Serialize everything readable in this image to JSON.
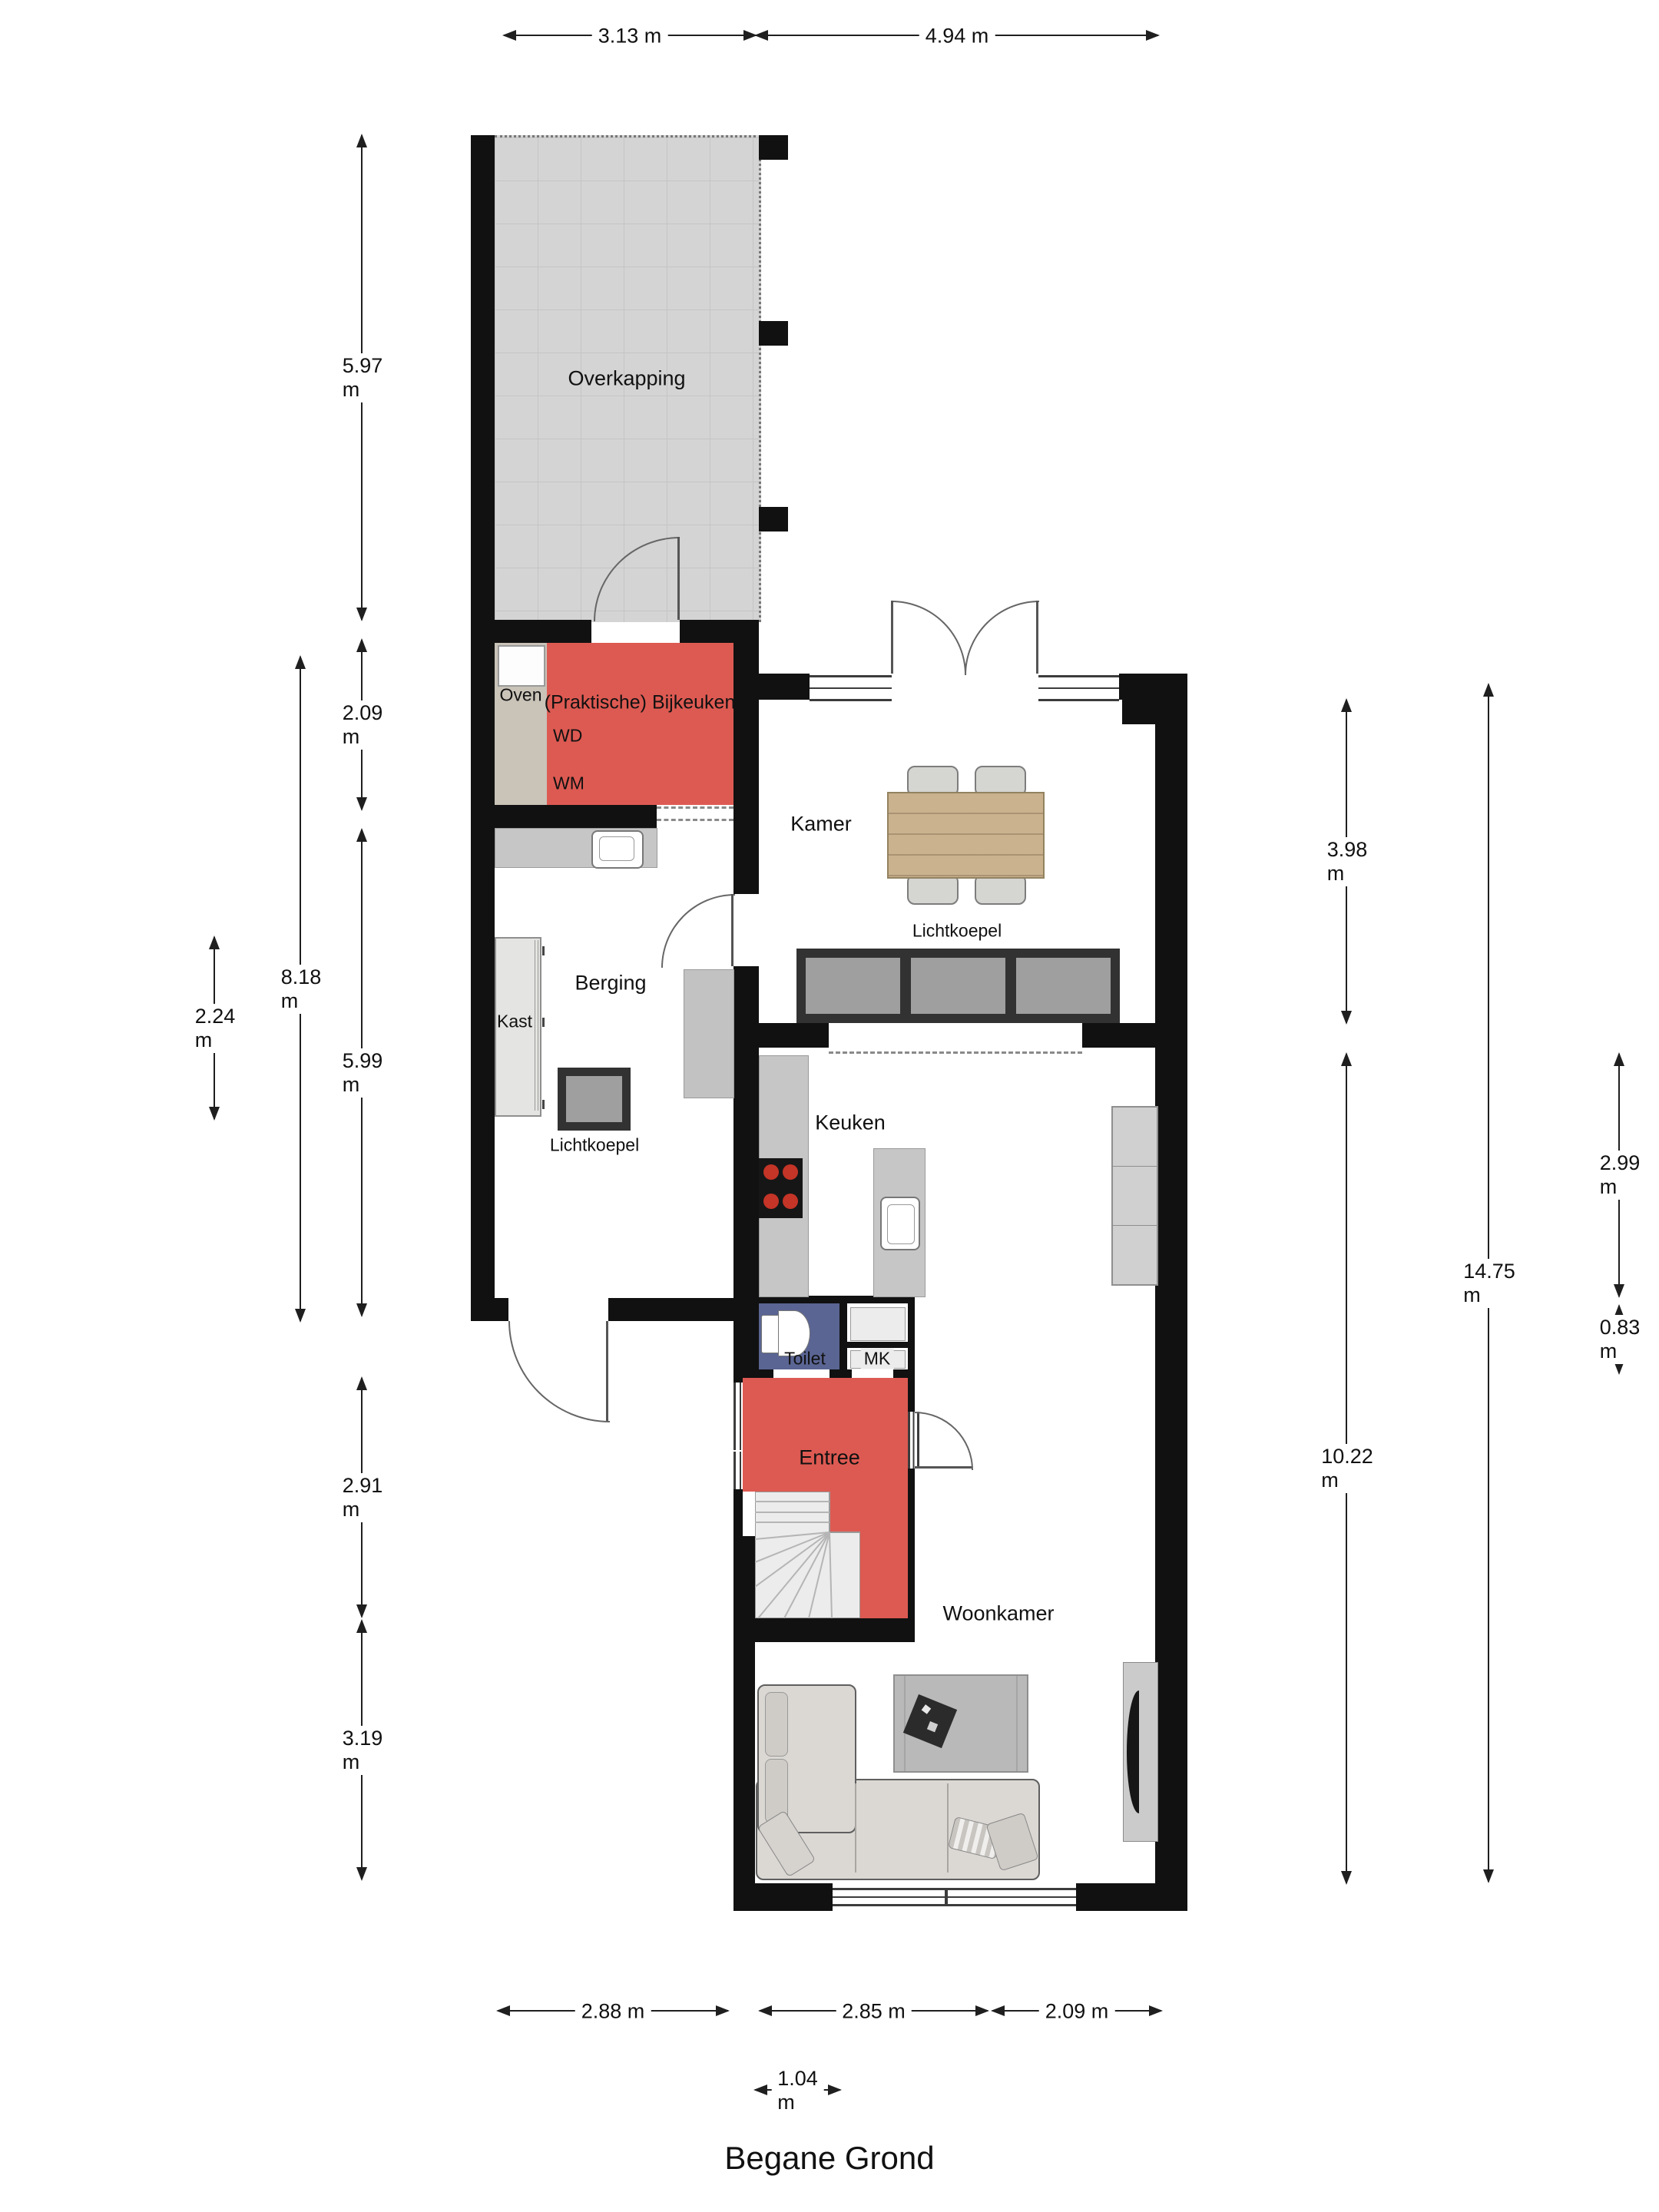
{
  "title": "Begane Grond",
  "rooms": {
    "overkapping": "Overkapping",
    "bijkeuken": "(Praktische) Bijkeuken",
    "kamer": "Kamer",
    "berging": "Berging",
    "keuken": "Keuken",
    "toilet": "Toilet",
    "mk": "MK",
    "entree": "Entree",
    "woonkamer": "Woonkamer"
  },
  "features": {
    "oven": "Oven",
    "wd": "WD",
    "wm": "WM",
    "kast": "Kast",
    "lichtkoepel_kamer": "Lichtkoepel",
    "lichtkoepel_berging": "Lichtkoepel"
  },
  "dimensions": {
    "top": [
      "3.13 m",
      "4.94 m"
    ],
    "left": [
      "5.97 m",
      "2.09 m",
      "8.18 m",
      "2.24 m",
      "5.99 m",
      "2.91 m",
      "3.19 m"
    ],
    "right": [
      "3.98 m",
      "14.75 m",
      "2.99 m",
      "0.83 m",
      "10.22 m"
    ],
    "bottom": [
      "2.88 m",
      "2.85 m",
      "2.09 m",
      "1.04 m"
    ]
  },
  "colors": {
    "wall": "#111111",
    "accent_red": "#dd5a52",
    "toilet_blue": "#5a6593",
    "counter_gray": "#c6c6c6",
    "skylight_gray": "#9f9f9f",
    "tile_gray": "#d4d4d4"
  }
}
